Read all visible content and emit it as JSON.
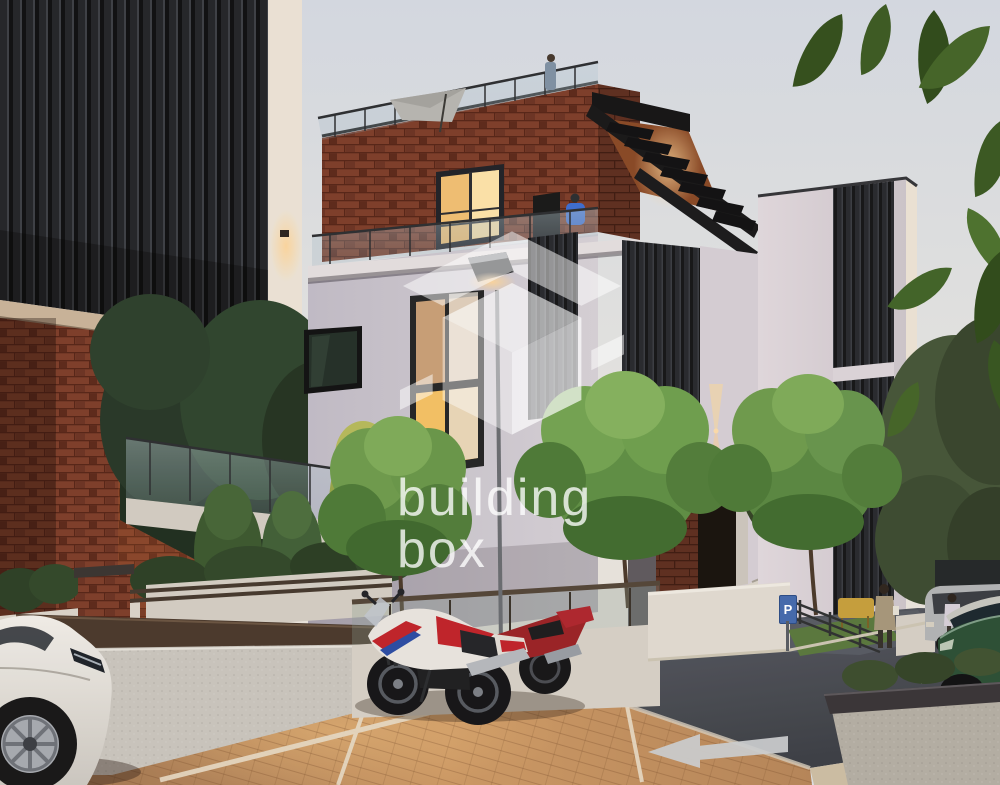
{
  "meta": {
    "type": "architectural-exterior-render",
    "setting": "modern residential complex at dusk",
    "lighting": "evening with warm accent lights"
  },
  "watermark": {
    "logo": "isometric-box-logo",
    "brand_line1": "building",
    "brand_line2": "box",
    "color": "#ffffff"
  },
  "signage": {
    "parking_sign_label": "P",
    "parking_sign_color": "#466aab"
  },
  "palette": {
    "sky": "#dfe4ec",
    "brick": "#7e3f2c",
    "dark_slats": "#1a1d21",
    "facade": "#cbc7d2",
    "warm_window": "#f2b457",
    "pavement": "#c08c5f",
    "asphalt": "#4a4f58",
    "foliage": "#5f9147",
    "white_car": "#e9e7e2",
    "green_car": "#2b5138",
    "bike_red": "#c2242c",
    "bike_blue": "#2b4ea8"
  },
  "scene": {
    "buildings": [
      "left block with dark vertical slat screen over red brick",
      "central house: brick top floor, rooftop glass terrace, white facade, slat accents",
      "stepped pergola canopy over side stair",
      "right tower with vertical slat screen"
    ],
    "vehicles": [
      "white coupe (foreground left)",
      "white-red-blue sport motorcycle",
      "red sport motorcycle",
      "grey minivan",
      "dark green crossover"
    ],
    "people": [
      "person standing on rooftop terrace",
      "seated person in blue on balcony",
      "man walking near entrance",
      "woman beside green car"
    ],
    "vegetation": [
      "ornamental courtyard trees",
      "conifer shrubs",
      "hedges",
      "overhanging chestnut leaves top right"
    ],
    "street_elements": [
      "paved parking bays with white lines",
      "asphalt driveway",
      "two white turn arrows",
      "blue P parking sign",
      "street lamp",
      "concrete planter box",
      "rooftop parasol"
    ]
  }
}
